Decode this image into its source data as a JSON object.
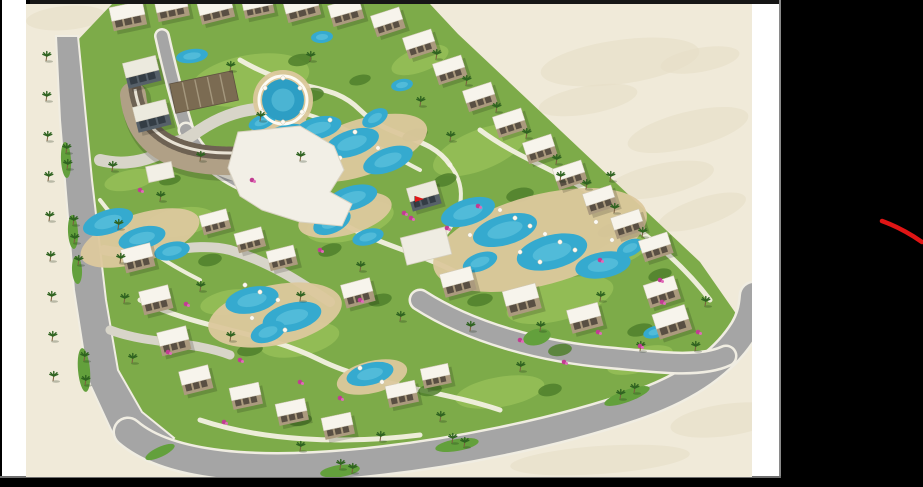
{
  "meta": {
    "description": "Video frame showing an aerial 3D master-plan rendering of a resort compound with pools, villas and palm-lined roads; black letterbox bars and a black right panel with a red hand-drawn annotation stroke.",
    "visible_text": ""
  },
  "frame": {
    "bg": "#000000",
    "left_strip": {
      "x": 2,
      "y": 0,
      "w": 24,
      "h": 478,
      "color": "#ffffff"
    },
    "top_bar": {
      "x": 30,
      "y": 0,
      "w": 751,
      "h": 4,
      "color": "#161616"
    },
    "right_strip": {
      "x": 752,
      "y": 4,
      "w": 27,
      "h": 474,
      "color": "#ffffff"
    },
    "divider": {
      "x": 779,
      "y": 0,
      "w": 2,
      "h": 478,
      "color": "#8a8a8a"
    },
    "gray_line": {
      "x": 0,
      "y": 476,
      "w": 781,
      "h": 2,
      "color": "#6f6f6f"
    },
    "bottom_bar": {
      "x": 0,
      "y": 478,
      "w": 923,
      "h": 9,
      "color": "#000000"
    },
    "image_area": {
      "x": 26,
      "y": 4,
      "w": 726,
      "h": 473
    }
  },
  "annotation": {
    "type": "freehand-stroke",
    "color": "#e01515",
    "width": 4.5,
    "d": "M 882,221 C 893,225 906,231 922,242"
  },
  "palette": {
    "sand": "#f0ead9",
    "sand_shade": "#e7dfc8",
    "grass": "#7dab49",
    "lawn": "#97c059",
    "shrub": "#4f7f2c",
    "road": "#a5a5a5",
    "road_edge": "#f0ede2",
    "light_path": "#d8d5c9",
    "footpath": "#f6f2e6",
    "median": "#63a03c",
    "deck": "#dcc89d",
    "pool": "#35aacf",
    "pool_light": "#64c6e0",
    "roof": "#f7f4ec",
    "wall": "#ab9a7e",
    "window": "#4a4238",
    "glass_roof": "#eceade",
    "glass_wall": "#566069",
    "pergola": "#7b6b52",
    "pergola_slat": "#a4977d",
    "palm_leaf": "#2f6320",
    "palm_trunk": "#7a5f3f",
    "flower": "#c13d92",
    "flag": "#e01818",
    "shadow": "rgba(0,0,0,0.16)"
  },
  "scene": {
    "blotches": [
      [
        620,
        62,
        80,
        22,
        -8
      ],
      [
        688,
        130,
        62,
        18,
        -14
      ],
      [
        588,
        100,
        50,
        14,
        -10
      ],
      [
        702,
        212,
        46,
        14,
        -18
      ],
      [
        726,
        420,
        56,
        16,
        -8
      ],
      [
        66,
        18,
        40,
        12,
        -5
      ],
      [
        660,
        180,
        55,
        16,
        -12
      ],
      [
        700,
        60,
        40,
        12,
        -10
      ],
      [
        600,
        460,
        90,
        14,
        -4
      ]
    ],
    "green_outline": "M 76,42 L 112,4 L 430,4 L 458,34 L 700,262 L 746,328 L 738,352 L 690,384 L 598,418 L 478,446 L 338,463 L 198,458 L 128,430 L 96,378 L 82,298 L 68,148 Z",
    "lawns": [
      [
        250,
        80,
        60,
        25,
        -10
      ],
      [
        480,
        150,
        50,
        20,
        -22
      ],
      [
        350,
        222,
        45,
        18,
        -15
      ],
      [
        560,
        300,
        55,
        20,
        -15
      ],
      [
        300,
        340,
        40,
        16,
        -12
      ],
      [
        180,
        222,
        35,
        14,
        -10
      ],
      [
        420,
        60,
        30,
        12,
        -20
      ],
      [
        620,
        252,
        30,
        12,
        -20
      ],
      [
        500,
        392,
        45,
        15,
        -10
      ],
      [
        230,
        302,
        30,
        12,
        -10
      ],
      [
        130,
        180,
        26,
        10,
        -12
      ],
      [
        640,
        360,
        34,
        12,
        -16
      ]
    ],
    "shrubs": [
      [
        310,
        95,
        14,
        7,
        -10
      ],
      [
        275,
        135,
        12,
        6,
        -20
      ],
      [
        415,
        135,
        13,
        6,
        -15
      ],
      [
        445,
        180,
        12,
        6,
        -18
      ],
      [
        520,
        195,
        14,
        7,
        -12
      ],
      [
        610,
        230,
        13,
        6,
        -20
      ],
      [
        660,
        275,
        12,
        6,
        -16
      ],
      [
        640,
        330,
        13,
        6,
        -14
      ],
      [
        560,
        350,
        12,
        6,
        -10
      ],
      [
        480,
        300,
        13,
        6,
        -12
      ],
      [
        330,
        250,
        12,
        6,
        -18
      ],
      [
        210,
        260,
        12,
        6,
        -12
      ],
      [
        250,
        350,
        13,
        6,
        -10
      ],
      [
        300,
        420,
        12,
        6,
        -8
      ],
      [
        380,
        300,
        12,
        6,
        -14
      ],
      [
        170,
        180,
        11,
        5,
        -12
      ],
      [
        430,
        390,
        12,
        6,
        -10
      ],
      [
        550,
        390,
        12,
        6,
        -12
      ],
      [
        300,
        60,
        12,
        6,
        -10
      ],
      [
        360,
        80,
        11,
        5,
        -14
      ]
    ],
    "left_road_polygon": "M 56,36 L 78,36 L 92,180 L 106,300 L 118,370 L 142,412 L 174,438 L 158,462 L 112,432 L 88,380 L 74,290 L 60,120 Z",
    "roads": [
      {
        "d": "M 128,432 C 170,468 260,472 350,464 C 450,455 560,432 640,404 C 690,386 724,362 744,330 C 750,320 753,310 754,296",
        "w": 26
      },
      {
        "d": "M 162,36 C 170,72 178,102 186,128",
        "w": 11
      },
      {
        "d": "M 420,300 C 470,332 540,352 612,358 C 656,362 700,368 726,356",
        "w": 18
      },
      {
        "d": "M 186,130 C 200,160 230,182 268,192",
        "w": 12
      }
    ],
    "light_paths": [
      {
        "d": "M 100,160 C 140,170 170,150 200,130 C 230,110 260,105 290,110",
        "w": 12
      },
      {
        "d": "M 104,250 C 150,260 190,240 230,250 C 270,262 300,282 330,302",
        "w": 10
      },
      {
        "d": "M 110,330 C 150,345 190,340 230,355",
        "w": 9
      }
    ],
    "footpaths": [
      {
        "d": "M 240,60 C 300,95 330,80 360,110 C 390,140 430,135 450,165",
        "w": 5
      },
      {
        "d": "M 180,150 C 230,190 290,185 330,215 C 370,245 420,250 470,280",
        "w": 5
      },
      {
        "d": "M 140,300 C 200,330 260,330 320,360 C 370,385 440,390 500,410",
        "w": 5
      },
      {
        "d": "M 480,130 C 520,160 560,170 600,200 C 640,230 680,260 710,300",
        "w": 5
      },
      {
        "d": "M 200,420 C 260,440 340,445 420,435",
        "w": 5
      },
      {
        "d": "M 100,200 C 130,240 160,260 200,280",
        "w": 4
      },
      {
        "d": "M 290,110 C 340,120 380,150 420,170",
        "w": 4
      },
      {
        "d": "M 450,165 C 470,190 460,220 440,240",
        "w": 4
      }
    ],
    "medians": [
      [
        66,
        160,
        5,
        18,
        -3
      ],
      [
        73,
        232,
        5,
        17,
        -3
      ],
      [
        77,
        270,
        5,
        14,
        -3
      ],
      [
        84,
        370,
        6,
        22,
        -5
      ],
      [
        340,
        471,
        20,
        6,
        -8
      ],
      [
        457,
        445,
        22,
        6,
        -10
      ],
      [
        627,
        396,
        24,
        6,
        -20
      ],
      [
        160,
        452,
        16,
        5,
        -25
      ]
    ],
    "roundabout": [
      537,
      337,
      14,
      8,
      -15
    ],
    "parking": {
      "x": 168,
      "y": 148,
      "w": 36,
      "h": 20,
      "r": -14
    },
    "decks": [
      [
        283,
        100,
        30,
        30,
        0
      ],
      [
        360,
        148,
        70,
        28,
        -18
      ],
      [
        540,
        240,
        110,
        45,
        -15
      ],
      [
        140,
        238,
        62,
        24,
        -18
      ],
      [
        275,
        315,
        68,
        30,
        -12
      ],
      [
        372,
        377,
        36,
        16,
        -14
      ],
      [
        345,
        215,
        48,
        20,
        -15
      ],
      [
        278,
        130,
        30,
        14,
        -16
      ]
    ],
    "pools": [
      [
        318,
        128,
        24,
        11,
        -14
      ],
      [
        352,
        143,
        28,
        13,
        -18
      ],
      [
        388,
        160,
        26,
        12,
        -20
      ],
      [
        402,
        85,
        11,
        6,
        -10
      ],
      [
        375,
        118,
        14,
        8,
        -30
      ],
      [
        285,
        135,
        22,
        10,
        -15
      ],
      [
        262,
        122,
        14,
        7,
        -20
      ],
      [
        192,
        56,
        16,
        7,
        -8
      ],
      [
        322,
        37,
        11,
        6,
        -5
      ],
      [
        468,
        212,
        28,
        13,
        -18
      ],
      [
        505,
        230,
        33,
        15,
        -16
      ],
      [
        552,
        252,
        36,
        17,
        -14
      ],
      [
        603,
        265,
        28,
        13,
        -10
      ],
      [
        480,
        262,
        18,
        9,
        -20
      ],
      [
        630,
        248,
        14,
        8,
        -25
      ],
      [
        352,
        198,
        26,
        12,
        -16
      ],
      [
        332,
        222,
        20,
        11,
        -25
      ],
      [
        368,
        237,
        16,
        8,
        -15
      ],
      [
        108,
        222,
        26,
        12,
        -18
      ],
      [
        142,
        238,
        24,
        11,
        -14
      ],
      [
        172,
        251,
        18,
        9,
        -12
      ],
      [
        252,
        300,
        27,
        13,
        -12
      ],
      [
        292,
        317,
        30,
        14,
        -14
      ],
      [
        268,
        332,
        18,
        10,
        -20
      ],
      [
        370,
        374,
        24,
        11,
        -14
      ],
      [
        655,
        332,
        12,
        6,
        -15
      ]
    ],
    "pool_round": {
      "cx": 283,
      "cy": 100,
      "r": 21
    },
    "umbrellas": [
      [
        500,
        210
      ],
      [
        515,
        218
      ],
      [
        530,
        226
      ],
      [
        545,
        234
      ],
      [
        560,
        242
      ],
      [
        575,
        250
      ],
      [
        520,
        252
      ],
      [
        540,
        262
      ],
      [
        470,
        235
      ],
      [
        245,
        285
      ],
      [
        260,
        292
      ],
      [
        278,
        300
      ],
      [
        252,
        318
      ],
      [
        285,
        330
      ],
      [
        265,
        88
      ],
      [
        300,
        88
      ],
      [
        262,
        112
      ],
      [
        302,
        112
      ],
      [
        283,
        78
      ],
      [
        283,
        122
      ],
      [
        330,
        120
      ],
      [
        355,
        132
      ],
      [
        378,
        148
      ],
      [
        340,
        158
      ],
      [
        360,
        368
      ],
      [
        382,
        382
      ],
      [
        596,
        222
      ],
      [
        612,
        240
      ]
    ],
    "crescent": {
      "outer": "M 133,95 Q 140,165 235,162",
      "outer_w": 26,
      "deco": "M 135,89 Q 144,154 233,153",
      "deco_w": 13
    },
    "pergola": {
      "x": 204,
      "y": 92,
      "w": 64,
      "h": 30,
      "r": -12
    },
    "clubhouse": "M 238,132 L 300,126 L 334,146 L 344,170 L 330,192 L 352,204 L 342,226 L 300,222 L 262,210 L 240,196 L 228,168 Z",
    "clubhouse_annex": {
      "x": 160,
      "y": 172,
      "w": 26,
      "h": 16,
      "r": -12
    },
    "pavilion": {
      "x": 426,
      "y": 246,
      "w": 46,
      "h": 28,
      "r": -14
    },
    "buildings": [
      [
        128,
        16,
        34,
        24,
        -12,
        "v"
      ],
      [
        172,
        8,
        32,
        22,
        -12,
        "v"
      ],
      [
        216,
        10,
        34,
        22,
        -14,
        "v"
      ],
      [
        258,
        6,
        30,
        20,
        -12,
        "v"
      ],
      [
        302,
        8,
        34,
        22,
        -15,
        "v"
      ],
      [
        346,
        12,
        32,
        22,
        -16,
        "v"
      ],
      [
        388,
        22,
        30,
        22,
        -18,
        "v"
      ],
      [
        420,
        44,
        30,
        22,
        -18,
        "v"
      ],
      [
        450,
        70,
        30,
        22,
        -18,
        "v"
      ],
      [
        480,
        97,
        30,
        22,
        -18,
        "v"
      ],
      [
        510,
        123,
        30,
        22,
        -18,
        "v"
      ],
      [
        540,
        149,
        30,
        22,
        -18,
        "v"
      ],
      [
        570,
        175,
        30,
        22,
        -18,
        "v"
      ],
      [
        600,
        200,
        30,
        22,
        -18,
        "v"
      ],
      [
        628,
        224,
        30,
        22,
        -18,
        "v"
      ],
      [
        656,
        247,
        30,
        22,
        -18,
        "v"
      ],
      [
        662,
        292,
        32,
        24,
        -18,
        "v"
      ],
      [
        672,
        322,
        34,
        26,
        -18,
        "v"
      ],
      [
        458,
        282,
        32,
        24,
        -15,
        "v"
      ],
      [
        522,
        300,
        34,
        26,
        -15,
        "v"
      ],
      [
        585,
        318,
        32,
        24,
        -15,
        "v"
      ],
      [
        358,
        293,
        30,
        24,
        -15,
        "v"
      ],
      [
        142,
        72,
        34,
        26,
        -14,
        "g"
      ],
      [
        152,
        116,
        34,
        26,
        -14,
        "g"
      ],
      [
        424,
        196,
        30,
        24,
        -16,
        "g"
      ],
      [
        215,
        222,
        28,
        20,
        -15,
        "v"
      ],
      [
        250,
        240,
        28,
        20,
        -15,
        "v"
      ],
      [
        282,
        258,
        28,
        20,
        -14,
        "v"
      ],
      [
        138,
        258,
        30,
        24,
        -14,
        "v"
      ],
      [
        156,
        300,
        30,
        24,
        -14,
        "v"
      ],
      [
        174,
        341,
        30,
        24,
        -14,
        "v"
      ],
      [
        196,
        380,
        30,
        24,
        -14,
        "v"
      ],
      [
        246,
        396,
        30,
        22,
        -12,
        "v"
      ],
      [
        292,
        412,
        30,
        22,
        -12,
        "v"
      ],
      [
        338,
        426,
        30,
        22,
        -12,
        "v"
      ],
      [
        402,
        394,
        30,
        22,
        -12,
        "v"
      ],
      [
        436,
        376,
        28,
        20,
        -12,
        "v"
      ]
    ],
    "palms": [
      [
        46,
        60
      ],
      [
        46,
        100
      ],
      [
        47,
        140
      ],
      [
        48,
        180
      ],
      [
        49,
        220
      ],
      [
        50,
        260
      ],
      [
        51,
        300
      ],
      [
        52,
        340
      ],
      [
        53,
        380
      ],
      [
        66,
        152
      ],
      [
        67,
        168
      ],
      [
        73,
        224
      ],
      [
        74,
        242
      ],
      [
        78,
        264
      ],
      [
        84,
        360
      ],
      [
        85,
        384
      ],
      [
        340,
        468
      ],
      [
        352,
        472
      ],
      [
        452,
        442
      ],
      [
        464,
        446
      ],
      [
        620,
        398
      ],
      [
        634,
        392
      ],
      [
        436,
        58
      ],
      [
        466,
        84
      ],
      [
        496,
        111
      ],
      [
        526,
        137
      ],
      [
        556,
        163
      ],
      [
        586,
        188
      ],
      [
        614,
        212
      ],
      [
        642,
        236
      ],
      [
        230,
        70
      ],
      [
        310,
        60
      ],
      [
        260,
        120
      ],
      [
        420,
        105
      ],
      [
        450,
        140
      ],
      [
        300,
        160
      ],
      [
        200,
        160
      ],
      [
        160,
        200
      ],
      [
        120,
        262
      ],
      [
        200,
        290
      ],
      [
        230,
        340
      ],
      [
        300,
        300
      ],
      [
        360,
        270
      ],
      [
        400,
        320
      ],
      [
        470,
        330
      ],
      [
        540,
        330
      ],
      [
        600,
        300
      ],
      [
        640,
        350
      ],
      [
        520,
        370
      ],
      [
        440,
        420
      ],
      [
        380,
        440
      ],
      [
        300,
        450
      ],
      [
        560,
        180
      ],
      [
        610,
        180
      ],
      [
        695,
        350
      ],
      [
        705,
        305
      ],
      [
        112,
        170
      ],
      [
        118,
        228
      ],
      [
        124,
        302
      ],
      [
        132,
        362
      ]
    ],
    "flowers": [
      [
        404,
        213
      ],
      [
        411,
        218
      ],
      [
        447,
        228
      ],
      [
        478,
        206
      ],
      [
        300,
        382
      ],
      [
        340,
        398
      ],
      [
        598,
        332
      ],
      [
        640,
        346
      ],
      [
        698,
        332
      ],
      [
        186,
        304
      ],
      [
        168,
        352
      ],
      [
        224,
        422
      ],
      [
        564,
        362
      ],
      [
        662,
        302
      ],
      [
        252,
        180
      ],
      [
        140,
        190
      ],
      [
        360,
        300
      ],
      [
        520,
        340
      ],
      [
        600,
        260
      ],
      [
        660,
        280
      ],
      [
        240,
        360
      ],
      [
        320,
        250
      ]
    ],
    "flag": {
      "x": 415,
      "y": 196
    }
  }
}
